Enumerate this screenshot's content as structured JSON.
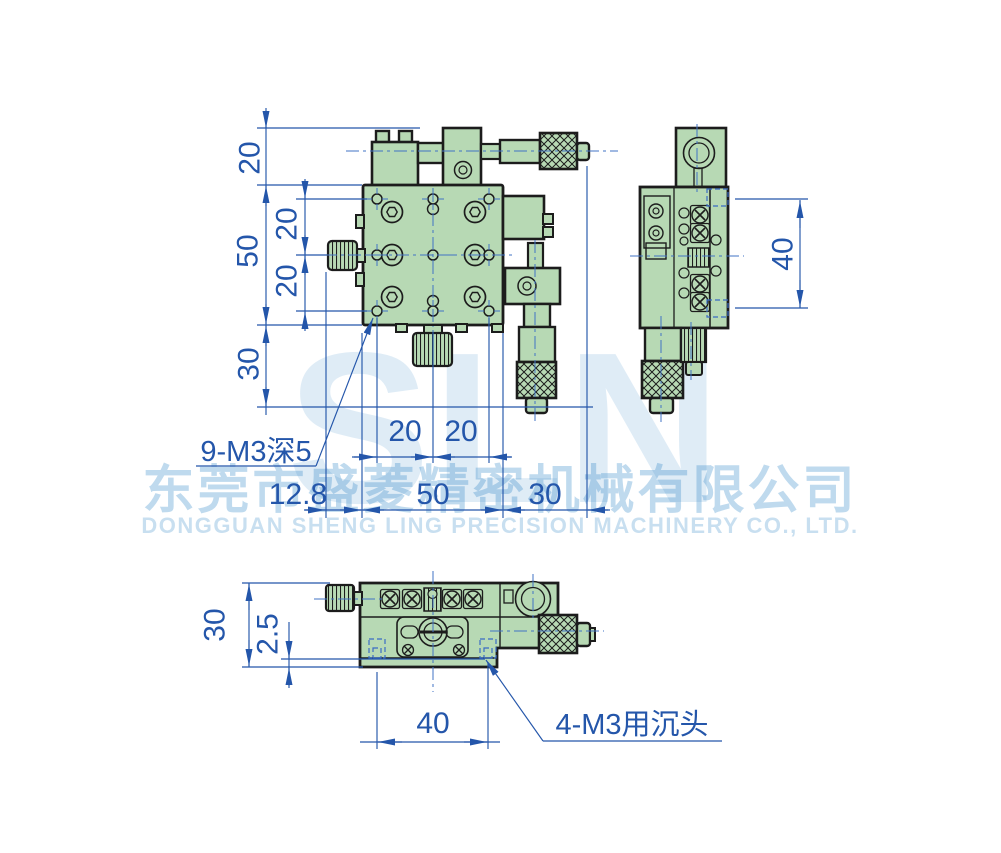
{
  "watermark": {
    "logo": "SLN",
    "company_cn": "东莞市盛菱精密机械有限公司",
    "company_en": "DONGGUAN SHENG LING PRECISION MACHINERY CO., LTD."
  },
  "front_view": {
    "dim_top_offset": "20",
    "dim_height": "50",
    "dim_row_upper": "20",
    "dim_row_lower": "20",
    "dim_bottom_offset": "30",
    "dim_col_left": "20",
    "dim_col_right": "20",
    "dim_knob": "12.8",
    "dim_width": "50",
    "dim_right_offset": "30",
    "callout_holes": "9-M3深5"
  },
  "side_view": {
    "dim_height": "40"
  },
  "bottom_view": {
    "dim_height": "30",
    "dim_plate": "2.5",
    "dim_hole_span": "40",
    "callout_holes": "4-M3用沉头"
  },
  "colors": {
    "body_green": "#b7d9b4",
    "outline": "#1c1c1c",
    "dimension_blue": "#2456aa",
    "centerline_blue": "#4273c4",
    "watermark_blue": "#2e86c8"
  }
}
